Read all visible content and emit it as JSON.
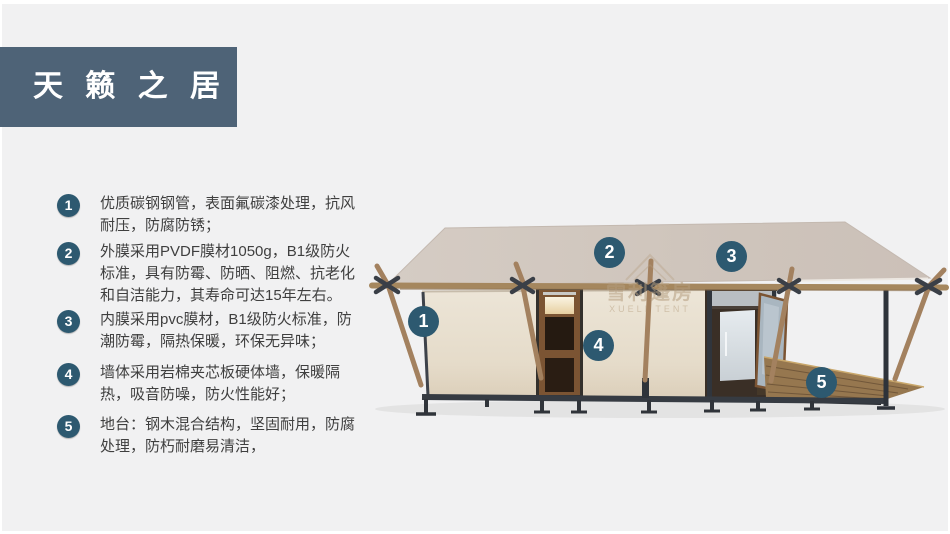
{
  "header": {
    "title": "天 籁 之 居"
  },
  "features": [
    {
      "num": "1",
      "text": "优质碳钢钢管，表面氟碳漆处理，抗风耐压，防腐防锈；"
    },
    {
      "num": "2",
      "text": "外膜采用PVDF膜材1050g，B1级防火标准，具有防霉、防晒、阻燃、抗老化和自洁能力，其寿命可达15年左右。"
    },
    {
      "num": "3",
      "text": "内膜采用pvc膜材，B1级防火标准，防潮防霉，隔热保暖，环保无异味；"
    },
    {
      "num": "4",
      "text": "墙体采用岩棉夹芯板硬体墙，保暖隔热，吸音防噪，防火性能好；"
    },
    {
      "num": "5",
      "text": "地台：钢木混合结构，坚固耐用，防腐处理，防朽耐磨易清洁，"
    }
  ],
  "diagram": {
    "callouts": [
      {
        "num": "1"
      },
      {
        "num": "2"
      },
      {
        "num": "3"
      },
      {
        "num": "4"
      },
      {
        "num": "5"
      }
    ],
    "watermark": {
      "cn": "雪利篷房",
      "en": "XUELI TENT"
    }
  },
  "colors": {
    "accent": "#2d5970",
    "header_bg": "#4e6377",
    "roof": "#cfc5bc",
    "wall": "#e9e1d3",
    "wood": "#a3815f"
  }
}
